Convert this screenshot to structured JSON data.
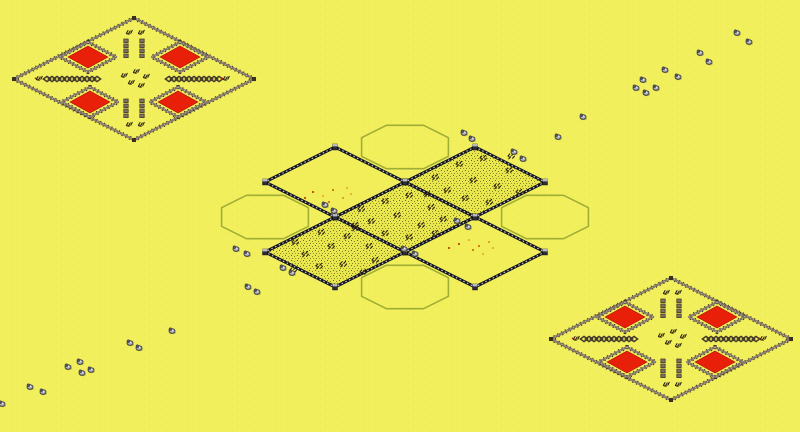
{
  "scene": {
    "width": 800,
    "height": 432,
    "colors": {
      "background": "#f2ef5c",
      "grain_light": "#faf77c",
      "grain_dark": "#e6e348",
      "plain_cell": "#f1ee5a",
      "scrub_base": "#e9e74e",
      "speckle1": "#8a8420",
      "speckle2": "#6a641a",
      "speckle3": "#a09a28",
      "palisade_base": "#7d7264",
      "palisade_spike": "#39301f",
      "palisade_light": "#cdc2a8",
      "stone_dark": "#16161f",
      "stone_stud": "#d2d2da",
      "tower_fill": "#2c2c36",
      "tower_top": "#b9b9c2",
      "roof_red": "#e8200a",
      "roof_edge": "#a81304",
      "outline_green": "#9fae35",
      "unit_dark": "#2a2110",
      "unit_red": "#d01808",
      "rock_body": "#b0b0b8",
      "rock_head": "#54545e",
      "rock_line": "#3a3a42",
      "rock_highlight": "#dfdfe6",
      "rock_shadow": "#8a8a38",
      "debris_orange": "#d87010",
      "debris_red": "#c04808"
    }
  },
  "forts": [
    {
      "id": "fort-northwest",
      "cx": 134,
      "cy": 79
    },
    {
      "id": "fort-southeast",
      "cx": 671,
      "cy": 339
    }
  ],
  "fort_template": {
    "outer_half": [
      120,
      61
    ],
    "enclosure_offsets": [
      [
        -46,
        -22
      ],
      [
        46,
        -22
      ],
      [
        -44,
        23
      ],
      [
        44,
        23
      ]
    ],
    "enclosure_half": [
      28,
      15
    ],
    "roof_half": [
      20,
      11
    ],
    "column_xs": [
      -8,
      8
    ],
    "column_spans": [
      [
        -40,
        -20
      ],
      [
        20,
        40
      ]
    ],
    "chain_spans": [
      [
        -90,
        -32
      ],
      [
        32,
        90
      ]
    ],
    "center_units": [
      [
        -10,
        -4
      ],
      [
        2,
        -8
      ],
      [
        12,
        -3
      ],
      [
        -3,
        3
      ],
      [
        7,
        6
      ]
    ],
    "arm_units": [
      [
        -5,
        -47
      ],
      [
        7,
        -47
      ],
      [
        -5,
        45
      ],
      [
        7,
        45
      ],
      [
        -95,
        -1
      ],
      [
        92,
        -1
      ]
    ]
  },
  "citadel": {
    "cx": 405,
    "cy": 217,
    "cell_half": [
      70,
      35
    ],
    "cells": [
      {
        "id": "cell-northwest",
        "offset": [
          -70,
          -35
        ],
        "terrain": "plain"
      },
      {
        "id": "cell-northeast",
        "offset": [
          70,
          -35
        ],
        "terrain": "scrub"
      },
      {
        "id": "cell-center",
        "offset": [
          0,
          0
        ],
        "terrain": "scrub"
      },
      {
        "id": "cell-southwest",
        "offset": [
          -70,
          35
        ],
        "terrain": "scrub"
      },
      {
        "id": "cell-southeast",
        "offset": [
          70,
          35
        ],
        "terrain": "plain"
      }
    ],
    "squads": {
      "cell-northeast": [
        [
          -40,
          -5
        ],
        [
          -16,
          -18
        ],
        [
          8,
          -24
        ],
        [
          34,
          -12
        ],
        [
          -28,
          8
        ],
        [
          -2,
          -2
        ],
        [
          22,
          4
        ],
        [
          44,
          10
        ],
        [
          -10,
          16
        ],
        [
          14,
          20
        ],
        [
          36,
          -26
        ],
        [
          -48,
          12
        ]
      ],
      "cell-center": [
        [
          -44,
          -8
        ],
        [
          -20,
          -16
        ],
        [
          4,
          -22
        ],
        [
          26,
          -10
        ],
        [
          -34,
          4
        ],
        [
          -8,
          -2
        ],
        [
          16,
          8
        ],
        [
          38,
          2
        ],
        [
          -20,
          16
        ],
        [
          4,
          20
        ],
        [
          30,
          16
        ],
        [
          -50,
          8
        ]
      ],
      "cell-southwest": [
        [
          -40,
          -10
        ],
        [
          -14,
          -20
        ],
        [
          12,
          -16
        ],
        [
          34,
          -6
        ],
        [
          -30,
          2
        ],
        [
          -4,
          -6
        ],
        [
          20,
          -24
        ],
        [
          40,
          8
        ],
        [
          -16,
          14
        ],
        [
          8,
          12
        ],
        [
          28,
          20
        ],
        [
          -42,
          18
        ]
      ]
    },
    "debris": {
      "cell-northwest": [
        [
          -22,
          10
        ],
        [
          -12,
          14
        ],
        [
          -2,
          8
        ],
        [
          8,
          16
        ],
        [
          -6,
          20
        ],
        [
          12,
          6
        ],
        [
          -30,
          16
        ],
        [
          16,
          12
        ]
      ],
      "cell-southeast": [
        [
          -16,
          -8
        ],
        [
          -6,
          -12
        ],
        [
          4,
          -6
        ],
        [
          14,
          -10
        ],
        [
          -2,
          -2
        ],
        [
          18,
          -4
        ],
        [
          -26,
          -4
        ],
        [
          8,
          2
        ]
      ]
    },
    "outline_offsets": [
      [
        0,
        -70
      ],
      [
        0,
        70
      ],
      [
        -140,
        0
      ],
      [
        140,
        0
      ]
    ],
    "outline_half": [
      62,
      31
    ],
    "outline_corner_cut": 0.3
  },
  "rocks": [
    [
      737,
      33
    ],
    [
      749,
      42
    ],
    [
      700,
      53
    ],
    [
      709,
      62
    ],
    [
      665,
      70
    ],
    [
      678,
      77
    ],
    [
      643,
      80
    ],
    [
      636,
      88
    ],
    [
      646,
      93
    ],
    [
      656,
      88
    ],
    [
      583,
      117
    ],
    [
      558,
      137
    ],
    [
      514,
      152
    ],
    [
      523,
      159
    ],
    [
      464,
      133
    ],
    [
      472,
      139
    ],
    [
      325,
      205
    ],
    [
      334,
      211
    ],
    [
      457,
      221
    ],
    [
      468,
      227
    ],
    [
      404,
      249
    ],
    [
      415,
      254
    ],
    [
      236,
      249
    ],
    [
      247,
      254
    ],
    [
      283,
      268
    ],
    [
      292,
      273
    ],
    [
      248,
      287
    ],
    [
      257,
      292
    ],
    [
      172,
      331
    ],
    [
      130,
      343
    ],
    [
      139,
      348
    ],
    [
      68,
      367
    ],
    [
      80,
      362
    ],
    [
      82,
      373
    ],
    [
      91,
      370
    ],
    [
      30,
      387
    ],
    [
      43,
      392
    ],
    [
      2,
      404
    ]
  ]
}
